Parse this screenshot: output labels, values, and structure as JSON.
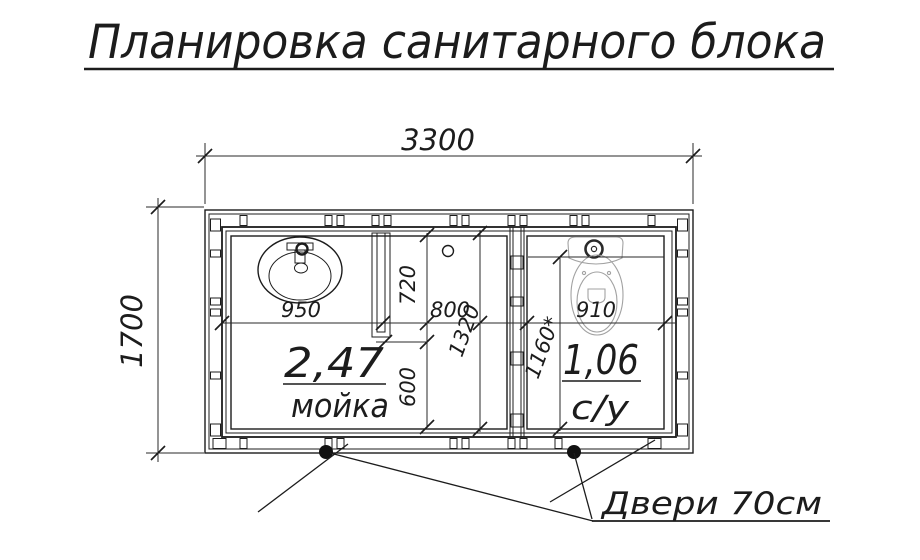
{
  "title": {
    "text": "Планировка санитарного блока"
  },
  "drawing": {
    "dimensions": {
      "overall_width": "3300",
      "overall_depth": "1700",
      "sink_zone_width": "950",
      "middle_zone_width": "800",
      "toilet_zone_width": "910",
      "front_depth": "720",
      "rear_depth": "600",
      "interior_depth": "1320",
      "toilet_room_depth": "1160*"
    },
    "rooms": {
      "washroom": {
        "area": "2,47",
        "name": "мойка"
      },
      "toilet_room": {
        "area": "1,06",
        "name": "с/у"
      }
    },
    "doors_note": "Двери 70см",
    "colors": {
      "line": "#1c1c1c",
      "fixture_light": "#a2a2a2",
      "background": "#ffffff"
    }
  }
}
